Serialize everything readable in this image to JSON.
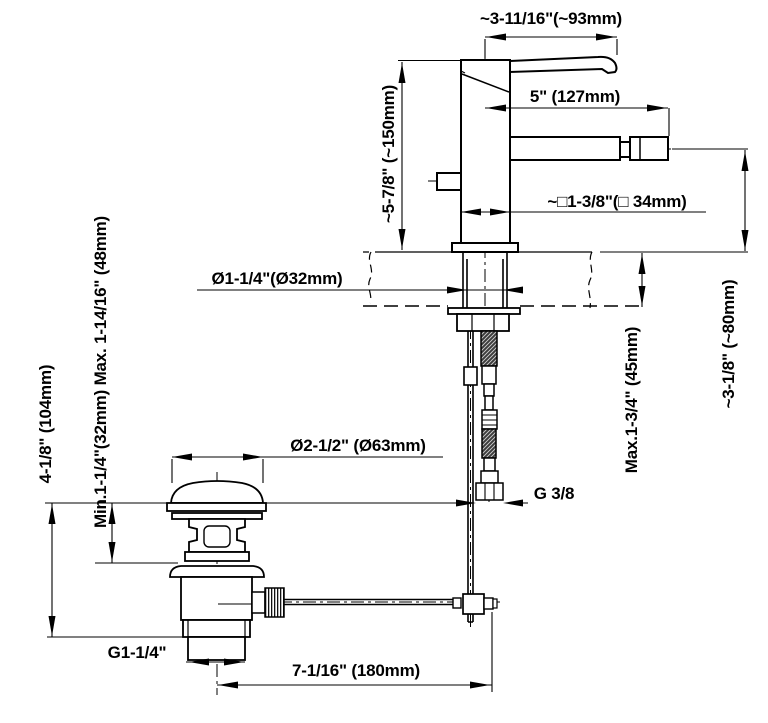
{
  "diagram": {
    "type": "faucet-installation-dimension-drawing",
    "line_color": "#000000",
    "background": "#ffffff",
    "labels": {
      "handle_reach": "~3-11/16\"(~93mm)",
      "spout_reach": "5\" (127mm)",
      "body_width": "~□1-3/8\"(□ 34mm)",
      "body_height": "~5-7/8\" (~150mm)",
      "hole_diameter": "Ø1-1/4\"(Ø32mm)",
      "deck_thickness_range": "Min.1-1/4\"(32mm) Max. 1-14/16\" (48mm)",
      "drain_height": "4-1/8\" (104mm)",
      "drain_flange_diameter": "Ø2-1/2\" (Ø63mm)",
      "supply_thread": "G 3/8",
      "drain_thread": "G1-1/4\"",
      "rod_offset": "7-1/16\" (180mm)",
      "deck_max_thickness": "Max.1-3/4\" (45mm)",
      "spout_height": "~3-1/8\" (~80mm)"
    }
  }
}
